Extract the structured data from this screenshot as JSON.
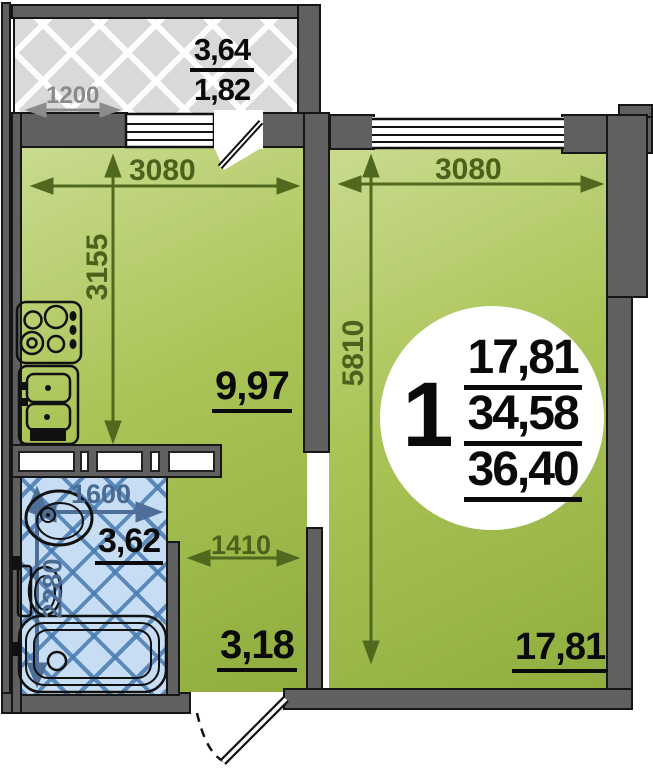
{
  "unit_badge": {
    "rooms_count": "1",
    "living_area": "17,81",
    "area_main": "34,58",
    "area_total": "36,40"
  },
  "balcony": {
    "area_full": "3,64",
    "area_half": "1,82",
    "width_dim": "1200"
  },
  "kitchen": {
    "area": "9,97",
    "width_dim": "3080",
    "depth_dim": "3155"
  },
  "living_room": {
    "area": "17,81",
    "width_dim": "3080",
    "depth_dim": "5810"
  },
  "bathroom": {
    "area": "3,62",
    "width_dim": "1600",
    "depth_dim": "2280"
  },
  "hallway": {
    "area": "3,18",
    "width_dim": "1410"
  },
  "colors": {
    "wall_gray": "#606060",
    "room_green": "#a5c052",
    "balcony_gray": "#d9d9d9",
    "bathroom_blue": "#c6ddf3",
    "dim_olive": "#4c611b",
    "dim_gray": "#8a8a8a",
    "dim_steel": "#4a6a92"
  }
}
